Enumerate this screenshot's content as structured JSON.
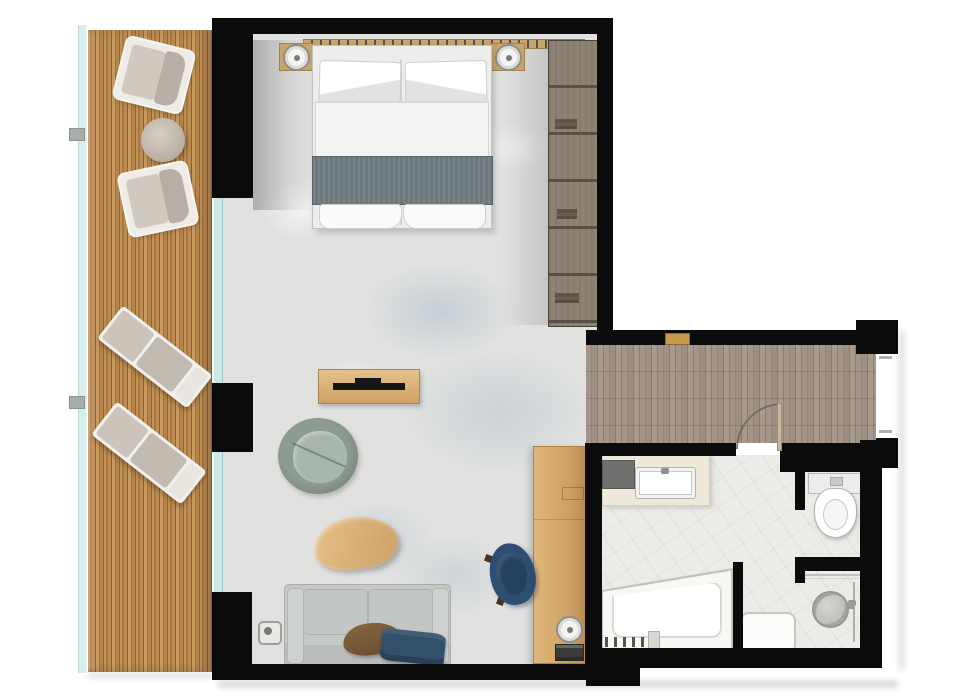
{
  "document": {
    "kind": "architectural floor plan, top-down view, hotel suite",
    "visible_text": "none"
  },
  "rooms": [
    {
      "id": "balcony",
      "label": "Balcony terrace",
      "floor": "vertical wood decking",
      "furniture": [
        "lounge-armchair",
        "round-side-table",
        "lounge-armchair",
        "sun-lounger",
        "sun-lounger"
      ],
      "features": [
        "glass-railing",
        "railing-brackets"
      ]
    },
    {
      "id": "bedroom-living",
      "label": "Bedroom / living room",
      "floor": "light terrazzo concrete with blue-grey mottling",
      "furniture": [
        "double-bed",
        "headboard",
        "nightstand-left",
        "table-lamp",
        "nightstand-right",
        "table-lamp",
        "bed-runner",
        "foot-cushions",
        "wardrobe",
        "tv-console",
        "tv-soundbar",
        "lounge-chair-sage",
        "organic-coffee-table",
        "sofa",
        "pillow-brown",
        "throw-navy",
        "floor-lamp",
        "desk",
        "desk-lamp",
        "books",
        "chair-navy"
      ],
      "features": [
        "floor-to-ceiling-glass-wall",
        "wall-columns"
      ]
    },
    {
      "id": "hallway",
      "label": "Entry hallway",
      "floor": "grey-brown wood planks",
      "features": [
        "entry-opening",
        "gold-threshold-accent",
        "bathroom-door-swing-arc"
      ]
    },
    {
      "id": "bathroom",
      "label": "Bathroom",
      "floor": "light tile",
      "fixtures": [
        "vanity-counter",
        "sink-basin",
        "faucet",
        "toilet",
        "wc-partition-walls",
        "bathtub",
        "tub-faucet-controls",
        "shower-partition",
        "rain-shower-head",
        "shower-bench",
        "shower-glass-rail"
      ]
    }
  ],
  "palette": {
    "wall": "#0b0b0b",
    "deck_wood": "#b5854a",
    "hall_wood": "#9c8e81",
    "living_floor": "#e1e2e0",
    "floor_mottle_blue": "#8aa2bc",
    "bath_tile": "#ecebe7",
    "wardrobe_wood": "#8e8274",
    "light_oak": "#d6ac70",
    "headboard_tan": "#c49f68",
    "gold_accent": "#c59a4b",
    "glass": "#cde7e6",
    "bed_linen": "#f2f2f0",
    "bed_runner": "#6d787d",
    "sofa_grey": "#c6cac7",
    "armchair_sage": "#96a59b",
    "chair_navy": "#2e4d72",
    "pillow_brown": "#7b5c3a",
    "throw_navy": "#33506b",
    "fixture_white": "#ffffff"
  }
}
